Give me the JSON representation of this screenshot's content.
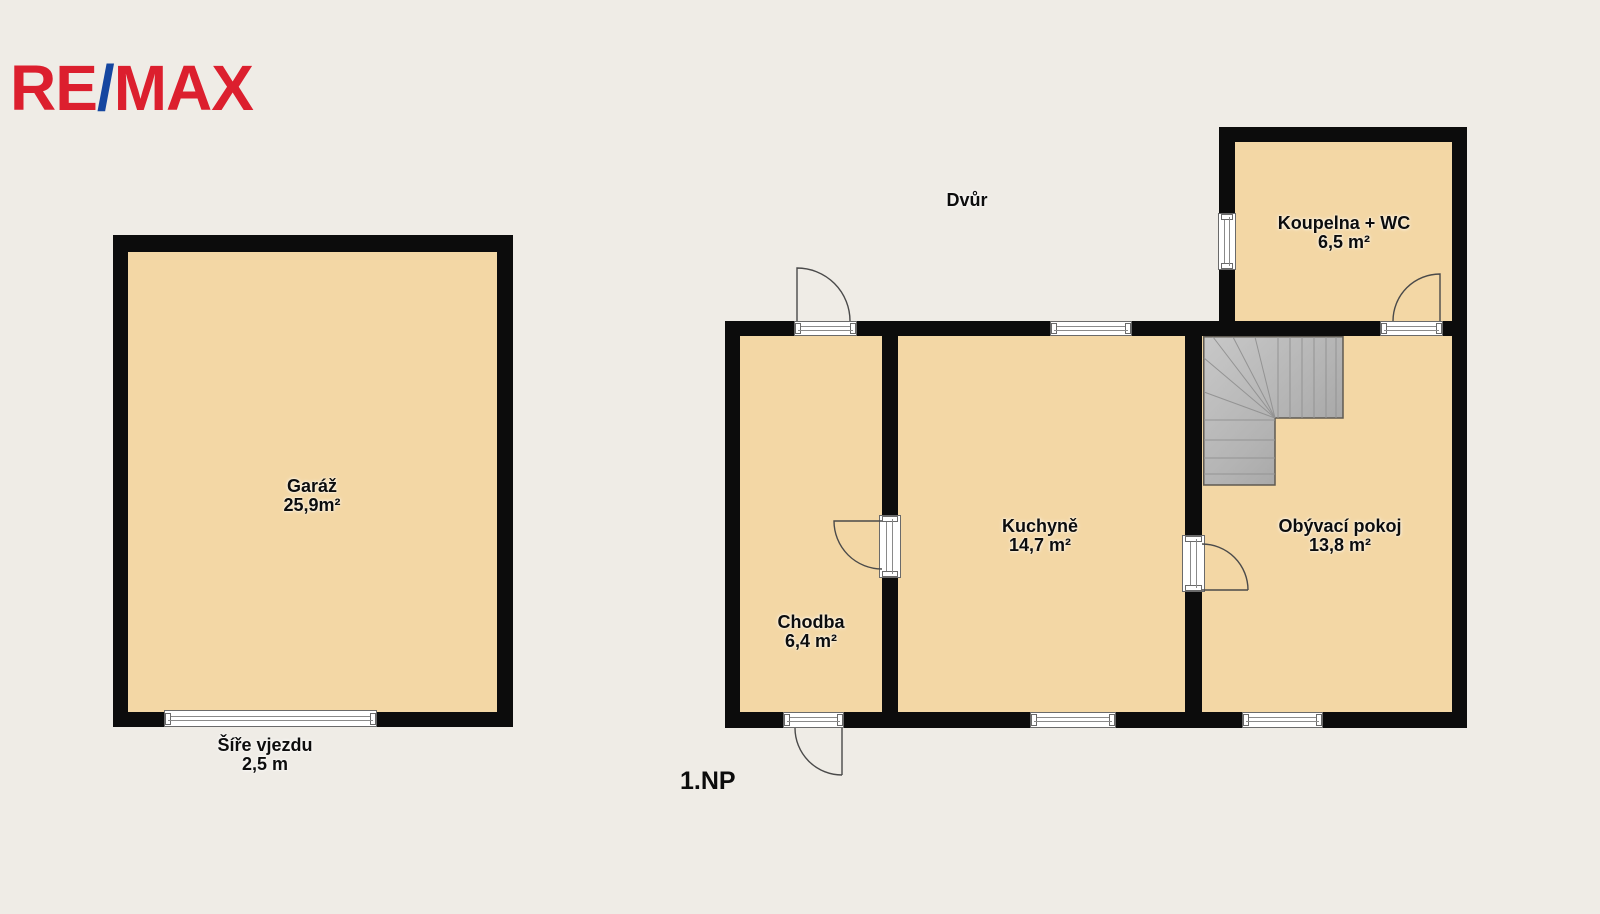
{
  "logo": {
    "re": "RE",
    "slash": "/",
    "max": "MAX"
  },
  "colors": {
    "background": "#efece6",
    "wall": "#0c0c0c",
    "floor_fill": "#f3d7a5",
    "stairs_gray": "#b5b5b5",
    "logo_red": "#dc1f2e",
    "logo_blue": "#1546a0"
  },
  "plan": {
    "floor_label": "1.NP",
    "courtyard_label": "Dvůr",
    "entrance": {
      "line1": "Šíře vjezdu",
      "line2": "2,5 m"
    },
    "rooms": [
      {
        "id": "garage",
        "name": "Garáž",
        "area": "25,9m²"
      },
      {
        "id": "hallway",
        "name": "Chodba",
        "area": "6,4 m²"
      },
      {
        "id": "kitchen",
        "name": "Kuchyně",
        "area": "14,7 m²"
      },
      {
        "id": "living-room",
        "name": "Obývací pokoj",
        "area": "13,8 m²"
      },
      {
        "id": "bathroom",
        "name": "Koupelna + WC",
        "area": "6,5 m²"
      }
    ]
  }
}
